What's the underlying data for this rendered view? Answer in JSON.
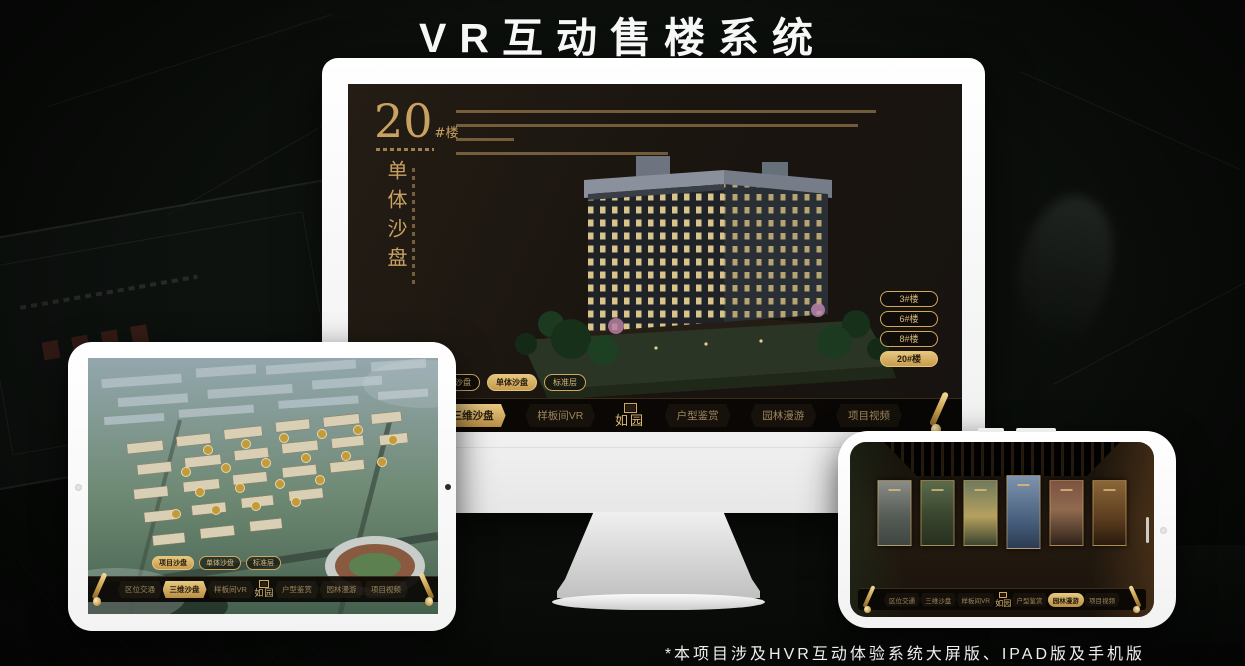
{
  "title": "VR互动售楼系统",
  "footnote": "*本项目涉及HVR互动体验系统大屏版、IPAD版及手机版",
  "colors": {
    "gold": "#d2a85f",
    "gold_bright": "#e0bb74",
    "screen_bg": "#1c1712",
    "nav_bg": "#090704"
  },
  "icons": {
    "nav_end": "scroll-icon",
    "brand_mark": "seal-icon"
  },
  "brand": {
    "name": "如园"
  },
  "nav_items": [
    "区位交通",
    "三维沙盘",
    "样板间VR",
    "户型鉴赏",
    "园林漫游",
    "项目视频"
  ],
  "sub_tabs": [
    "项目沙盘",
    "单体沙盘",
    "标准层"
  ],
  "monitor": {
    "building_no": "20",
    "building_no_suffix": "#楼",
    "building_subtitle": "单体沙盘",
    "floor_buttons": [
      "3#楼",
      "6#楼",
      "8#楼",
      "20#楼"
    ],
    "active_floor": "20#楼",
    "active_sub_tab": "单体沙盘",
    "active_nav": "三维沙盘"
  },
  "tablet": {
    "active_sub_tab": "项目沙盘",
    "active_nav": "三维沙盘"
  },
  "phone": {
    "active_nav": "园林漫游"
  }
}
